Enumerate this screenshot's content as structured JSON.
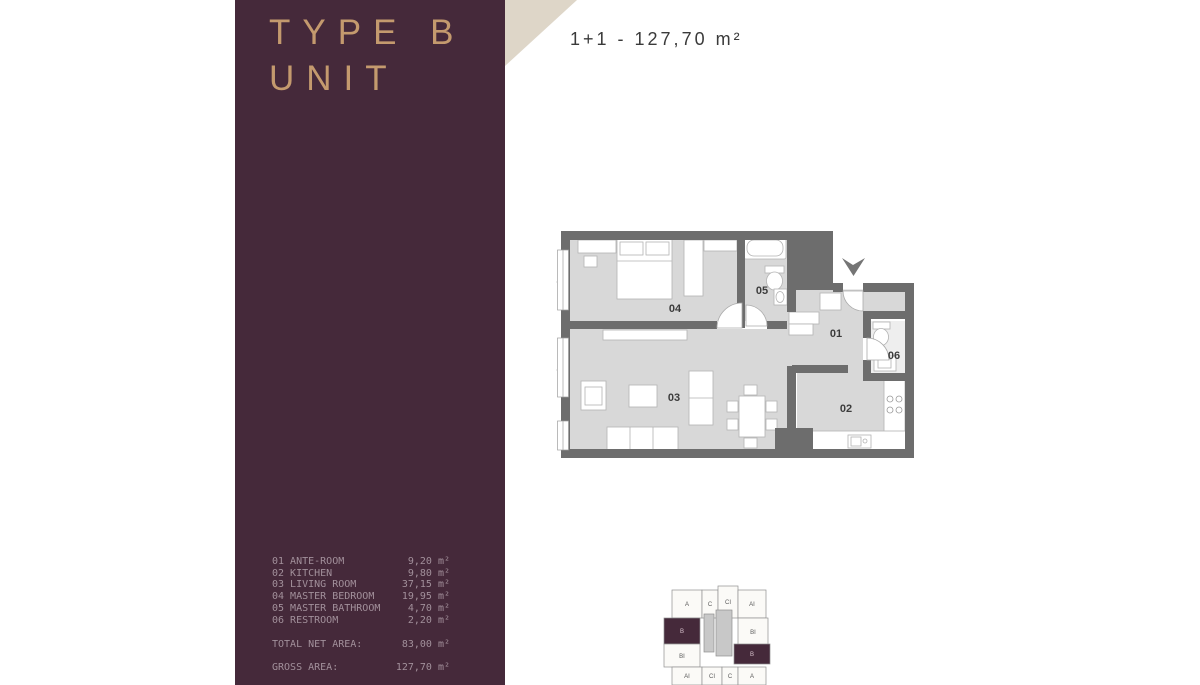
{
  "panel": {
    "title_line1": "TYPE B",
    "title_line2": "UNIT",
    "rooms": [
      {
        "num": "01",
        "name": "ANTE-ROOM",
        "value": "9,20 m²"
      },
      {
        "num": "02",
        "name": "KITCHEN",
        "value": "9,80 m²"
      },
      {
        "num": "03",
        "name": "LIVING ROOM",
        "value": "37,15 m²"
      },
      {
        "num": "04",
        "name": "MASTER BEDROOM",
        "value": "19,95 m²"
      },
      {
        "num": "05",
        "name": "MASTER BATHROOM",
        "value": "4,70 m²"
      },
      {
        "num": "06",
        "name": "RESTROOM",
        "value": "2,20 m²"
      }
    ],
    "total_net_label": "TOTAL NET AREA:",
    "total_net_value": "83,00 m²",
    "gross_label": "GROSS AREA:",
    "gross_value": "127,70 m²"
  },
  "header": {
    "unit_spec": "1+1 - 127,70 m²"
  },
  "plan": {
    "room_numbers": [
      "01",
      "02",
      "03",
      "04",
      "05",
      "06"
    ]
  },
  "keyplan": {
    "units": [
      "A",
      "C",
      "CI",
      "AI",
      "B",
      "BI",
      "BI",
      "B",
      "AI",
      "CI",
      "C",
      "A"
    ],
    "highlighted_unit": "B"
  },
  "colors": {
    "panel_purple": "#45293a",
    "accent_gold": "#c49a6e",
    "corner_beige": "#ded6c8",
    "wall_gray": "#6d6d6d",
    "floor_gray": "#d8d8d8",
    "list_text": "#a2909b",
    "spec_text": "#3a3a3a"
  }
}
